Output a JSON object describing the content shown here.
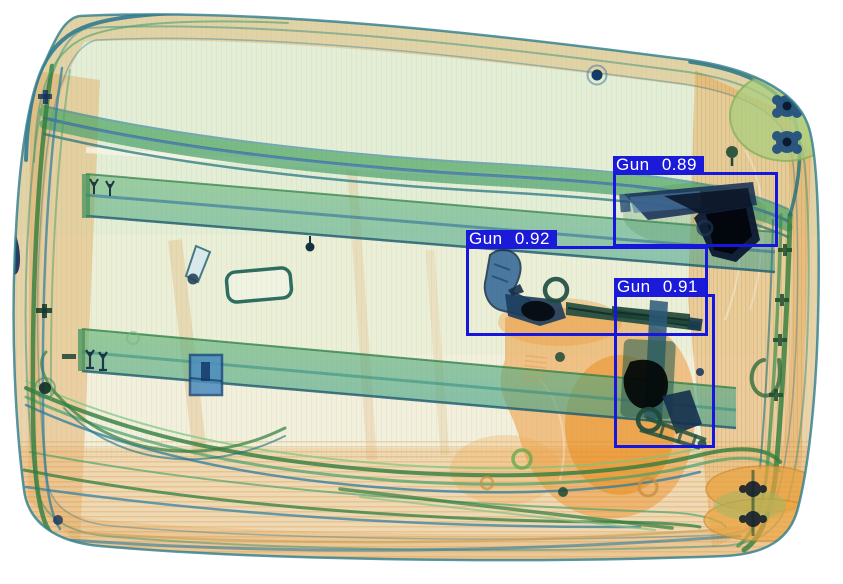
{
  "detections": [
    {
      "class_name": "Gun",
      "confidence": "0.89",
      "label_text": "Gun 0.89"
    },
    {
      "class_name": "Gun",
      "confidence": "0.92",
      "label_text": "Gun 0.92"
    },
    {
      "class_name": "Gun",
      "confidence": "0.91",
      "label_text": "Gun 0.91"
    }
  ],
  "colors": {
    "detection_box": "#1616dd",
    "label_background": "#1a1ad8",
    "label_text": "#ffffff",
    "background": "#ffffff",
    "xray_organic_orange": "#ec9430",
    "xray_fabric_green": "#57a868",
    "xray_metal_blue": "#16294a"
  }
}
